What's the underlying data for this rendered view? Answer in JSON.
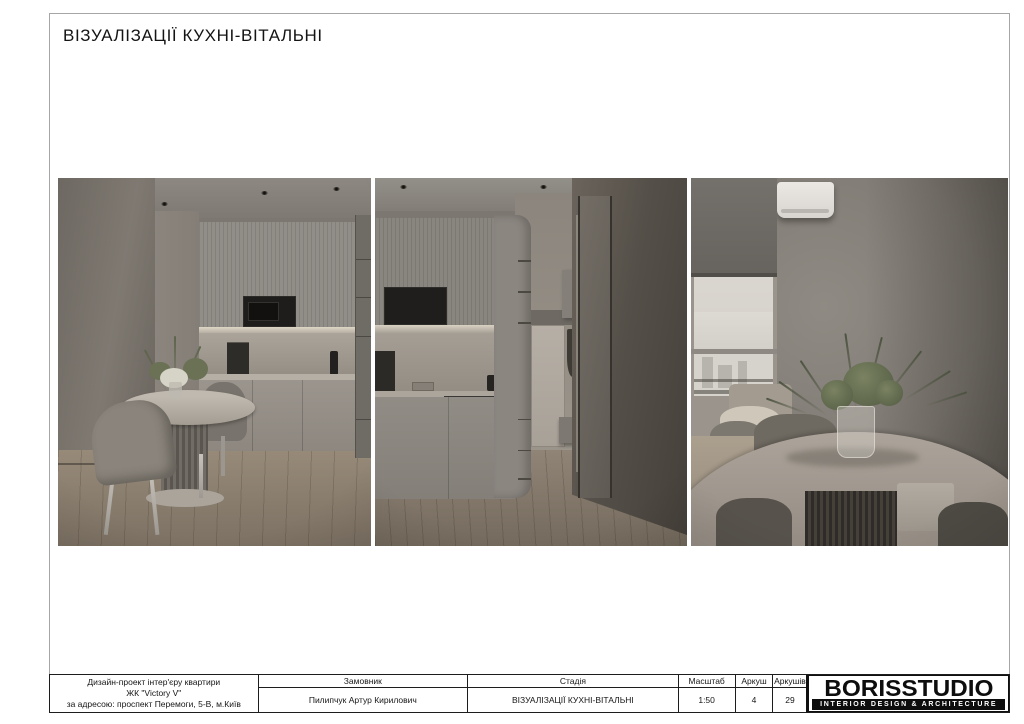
{
  "sheet": {
    "title": "ВІЗУАЛІЗАЦІЇ КУХНІ-ВІТАЛЬНІ"
  },
  "renders": [
    {
      "alt": "Кухня з фрезерованими фасадами, мікрохвильовою піччю та круглим обіднім столом зі стільцями"
    },
    {
      "alt": "Кухня та коридор із вхідними дверима, лавою і дзеркальною шафою"
    },
    {
      "alt": "Круглий обідній стіл з вазою зелені біля вікна з рулонною шторою та кондиціонером"
    }
  ],
  "title_block": {
    "project": {
      "line1": "Дизайн-проект інтер'єру квартири",
      "line2": "ЖК \"Victory V\"",
      "line3": "за адресою: проспект Перемоги, 5-В, м.Київ"
    },
    "client": {
      "label": "Замовник",
      "value": "Пилипчук Артур Кирилович"
    },
    "stage": {
      "label": "Стадія",
      "value": "ВІЗУАЛІЗАЦІЇ КУХНІ-ВІТАЛЬНІ"
    },
    "scale": {
      "label": "Масштаб",
      "value": "1:50"
    },
    "sheet": {
      "label": "Аркуш",
      "value": "4"
    },
    "sheets": {
      "label": "Аркушів",
      "value": "29"
    }
  },
  "logo": {
    "name": "BORISSTUDIO",
    "tagline": "INTERIOR DESIGN & ARCHITECTURE"
  },
  "colors": {
    "frame_border": "#a6a6a6",
    "table_lines": "#1d1d1d",
    "logo_bg": "#0d0d0d"
  }
}
